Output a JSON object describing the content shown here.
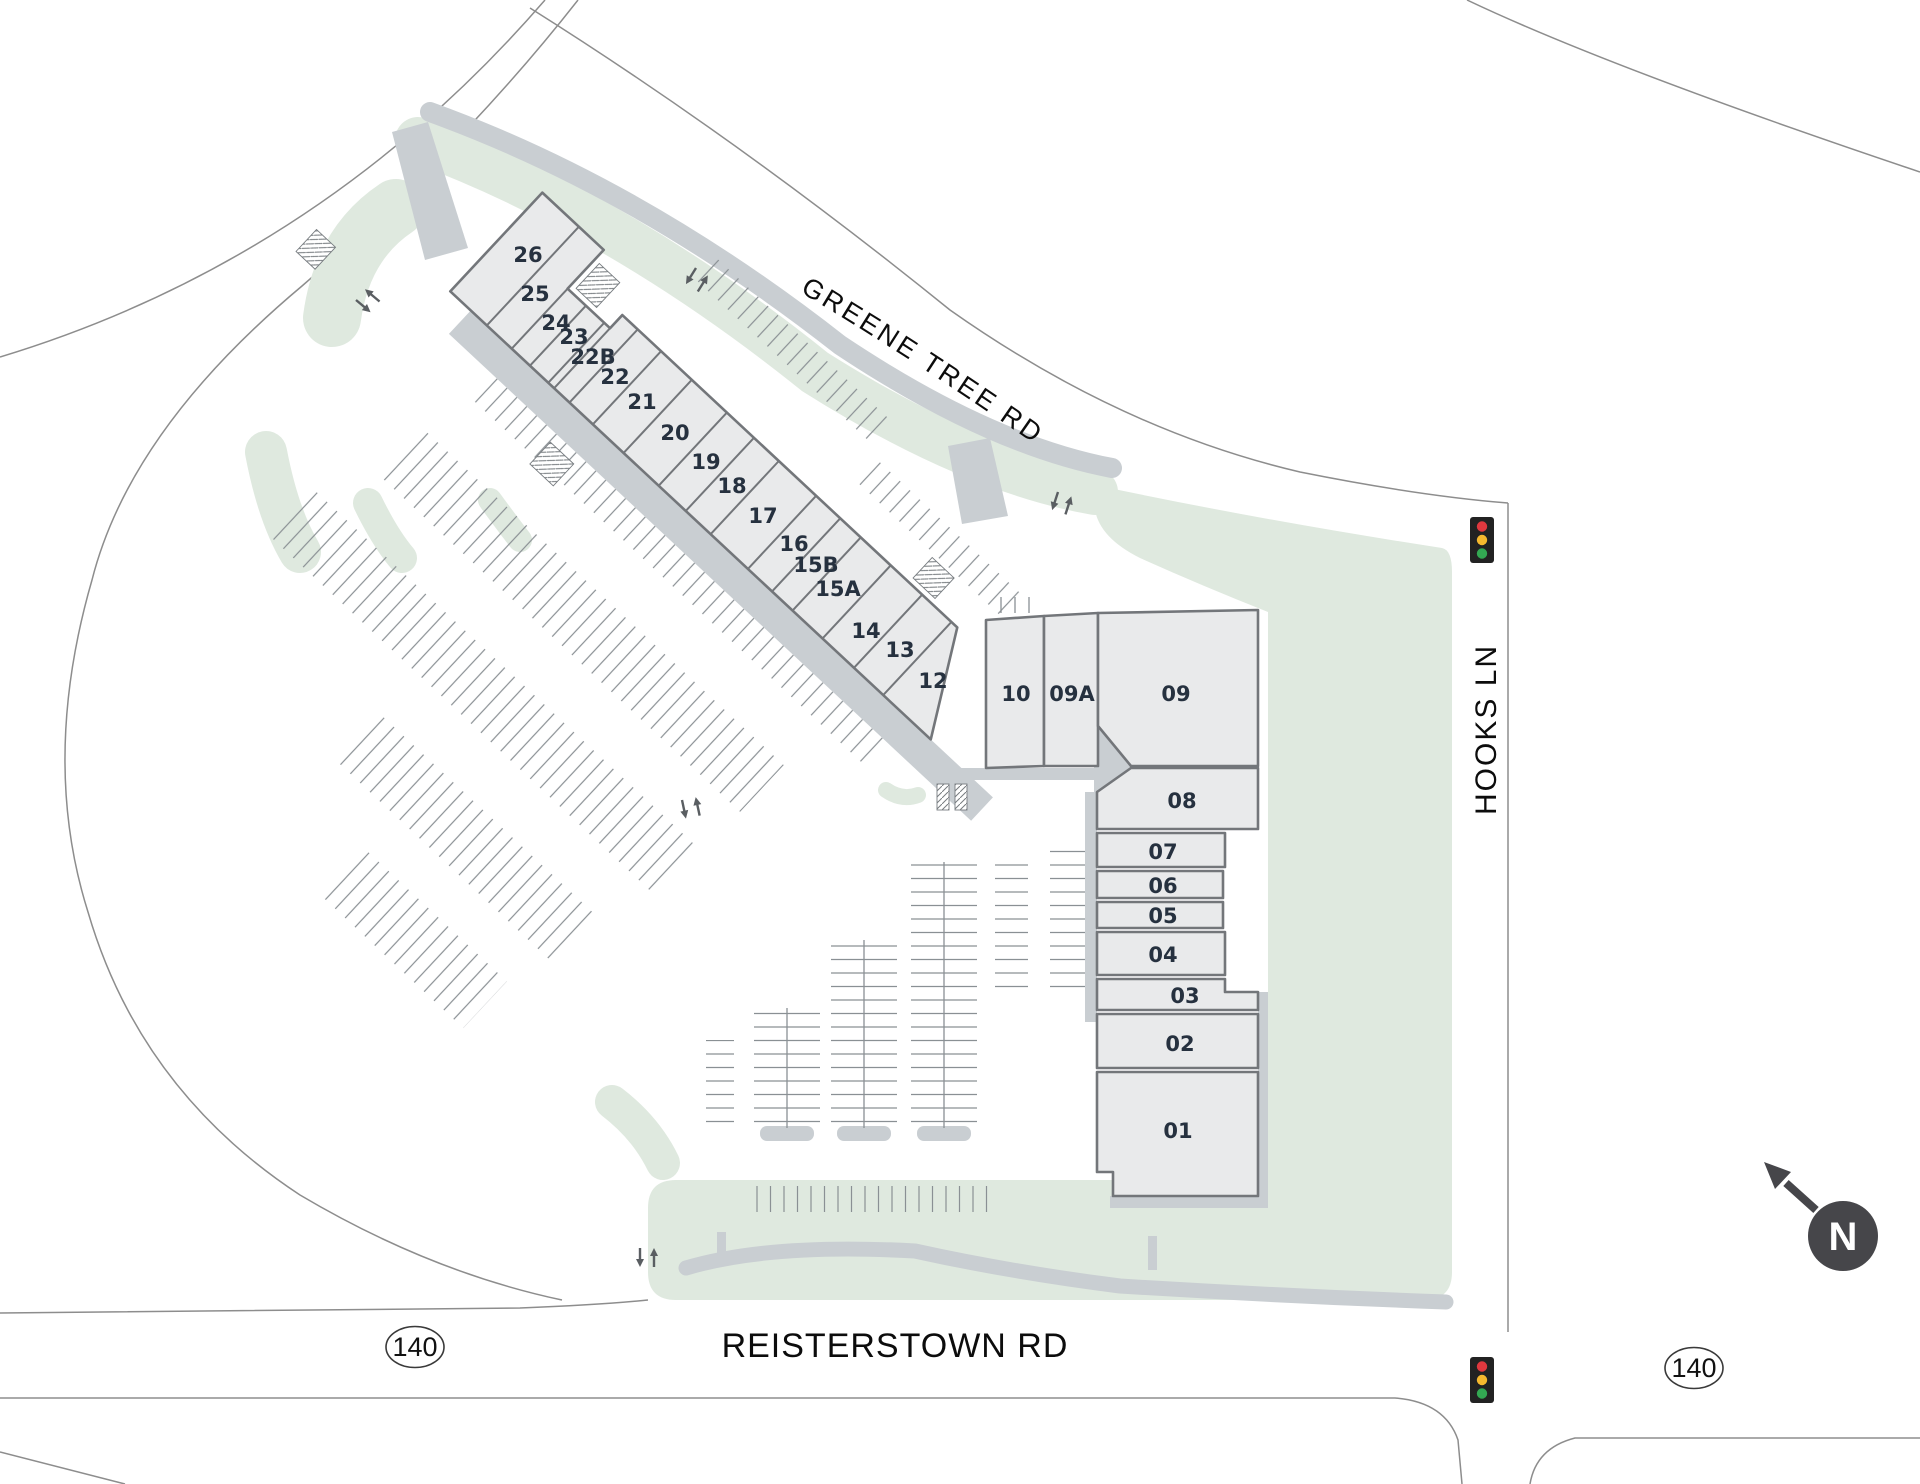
{
  "title": "Shopping center site plan",
  "streets": {
    "greene_tree": "GREENE TREE RD",
    "hooks": "HOOKS LN",
    "reisterstown": "REISTERSTOWN RD"
  },
  "route_shields": {
    "west": "140",
    "east": "140"
  },
  "compass": {
    "label": "N"
  },
  "units": [
    {
      "label": "26"
    },
    {
      "label": "25"
    },
    {
      "label": "24"
    },
    {
      "label": "23"
    },
    {
      "label": "22B"
    },
    {
      "label": "22"
    },
    {
      "label": "21"
    },
    {
      "label": "20"
    },
    {
      "label": "19"
    },
    {
      "label": "18"
    },
    {
      "label": "17"
    },
    {
      "label": "16"
    },
    {
      "label": "15B"
    },
    {
      "label": "15A"
    },
    {
      "label": "14"
    },
    {
      "label": "13"
    },
    {
      "label": "12"
    },
    {
      "label": "10"
    },
    {
      "label": "09A"
    },
    {
      "label": "09"
    },
    {
      "label": "08"
    },
    {
      "label": "07"
    },
    {
      "label": "06"
    },
    {
      "label": "05"
    },
    {
      "label": "04"
    },
    {
      "label": "03"
    },
    {
      "label": "02"
    },
    {
      "label": "01"
    }
  ],
  "icons": {
    "traffic_lights": 2,
    "north_compass": 1,
    "crosswalks": 6
  },
  "colors": {
    "page_bg": "#ffffff",
    "landscape": "#dfe9df",
    "pavement": "#c9ced2",
    "building_fill": "#e9eaeb",
    "building_outline": "#73767a",
    "unit_label": "#26313f",
    "road_line": "#8d8d8d",
    "parking_tick": "#8a9094",
    "signal_housing": "#222222",
    "signal_red": "#e0383e",
    "signal_amber": "#f5b82e",
    "signal_green": "#33a852",
    "compass": "#46464a"
  }
}
